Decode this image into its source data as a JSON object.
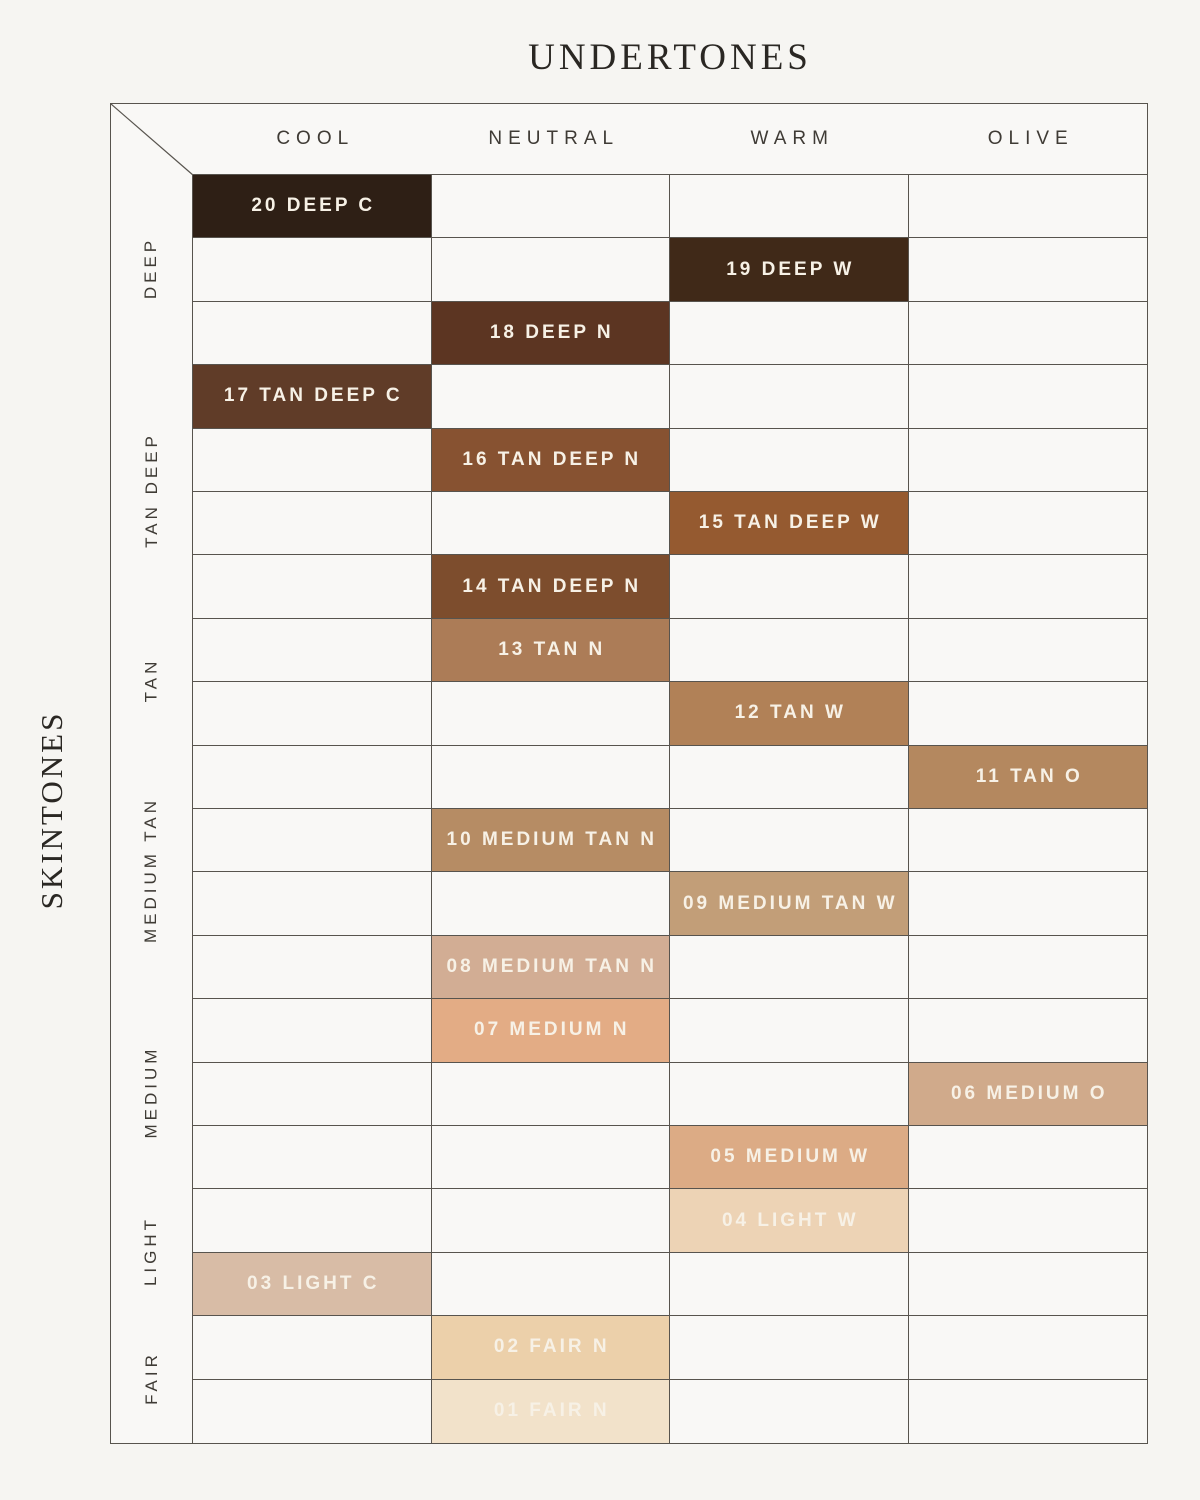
{
  "chart_data": {
    "type": "table",
    "title": "UNDERTONES",
    "row_axis_label": "SKINTONES",
    "columns": [
      "COOL",
      "NEUTRAL",
      "WARM",
      "OLIVE"
    ],
    "row_groups": [
      {
        "label": "DEEP",
        "rows": 3
      },
      {
        "label": "TAN DEEP",
        "rows": 4
      },
      {
        "label": "TAN",
        "rows": 2
      },
      {
        "label": "MEDIUM TAN",
        "rows": 4
      },
      {
        "label": "MEDIUM",
        "rows": 3
      },
      {
        "label": "LIGHT",
        "rows": 2
      },
      {
        "label": "FAIR",
        "rows": 2
      }
    ],
    "cells": [
      {
        "shade": "20 DEEP C",
        "column": "COOL",
        "skintone_group": "DEEP",
        "color": "#2e1f15"
      },
      {
        "shade": "19 DEEP W",
        "column": "WARM",
        "skintone_group": "DEEP",
        "color": "#402918"
      },
      {
        "shade": "18 DEEP N",
        "column": "NEUTRAL",
        "skintone_group": "DEEP",
        "color": "#5c3522"
      },
      {
        "shade": "17 TAN DEEP C",
        "column": "COOL",
        "skintone_group": "TAN DEEP",
        "color": "#603c28"
      },
      {
        "shade": "16 TAN DEEP N",
        "column": "NEUTRAL",
        "skintone_group": "TAN DEEP",
        "color": "#875231"
      },
      {
        "shade": "15 TAN DEEP W",
        "column": "WARM",
        "skintone_group": "TAN DEEP",
        "color": "#955a30"
      },
      {
        "shade": "14 TAN DEEP N",
        "column": "NEUTRAL",
        "skintone_group": "TAN DEEP",
        "color": "#7d4d2d"
      },
      {
        "shade": "13 TAN N",
        "column": "NEUTRAL",
        "skintone_group": "TAN",
        "color": "#ac7c57"
      },
      {
        "shade": "12 TAN W",
        "column": "WARM",
        "skintone_group": "TAN",
        "color": "#b18157"
      },
      {
        "shade": "11 TAN O",
        "column": "OLIVE",
        "skintone_group": "MEDIUM TAN",
        "color": "#b4885f"
      },
      {
        "shade": "10 MEDIUM TAN N",
        "column": "NEUTRAL",
        "skintone_group": "MEDIUM TAN",
        "color": "#b68c64"
      },
      {
        "shade": "09 MEDIUM TAN W",
        "column": "WARM",
        "skintone_group": "MEDIUM TAN",
        "color": "#c29e78"
      },
      {
        "shade": "08 MEDIUM TAN N",
        "column": "NEUTRAL",
        "skintone_group": "MEDIUM TAN",
        "color": "#d2ad94"
      },
      {
        "shade": "07 MEDIUM N",
        "column": "NEUTRAL",
        "skintone_group": "MEDIUM",
        "color": "#e3ac85"
      },
      {
        "shade": "06 MEDIUM O",
        "column": "OLIVE",
        "skintone_group": "MEDIUM",
        "color": "#d0aa8b"
      },
      {
        "shade": "05 MEDIUM W",
        "column": "WARM",
        "skintone_group": "MEDIUM",
        "color": "#dcab85"
      },
      {
        "shade": "04 LIGHT W",
        "column": "WARM",
        "skintone_group": "LIGHT",
        "color": "#edd3b5"
      },
      {
        "shade": "03 LIGHT C",
        "column": "COOL",
        "skintone_group": "LIGHT",
        "color": "#d8bca6"
      },
      {
        "shade": "02 FAIR N",
        "column": "NEUTRAL",
        "skintone_group": "FAIR",
        "color": "#ecd0aa"
      },
      {
        "shade": "01 FAIR N",
        "column": "NEUTRAL",
        "skintone_group": "FAIR",
        "color": "#f2e2ca"
      }
    ],
    "theme": {
      "page_background": "#f6f5f2",
      "empty_cell_background": "#f9f8f6",
      "grid_line_color": "#58544e",
      "cell_text_color": "#f7f1e6",
      "heading_text_color": "#3f3b35"
    },
    "layout_hints": {
      "legend": "none",
      "grid": "on"
    }
  }
}
